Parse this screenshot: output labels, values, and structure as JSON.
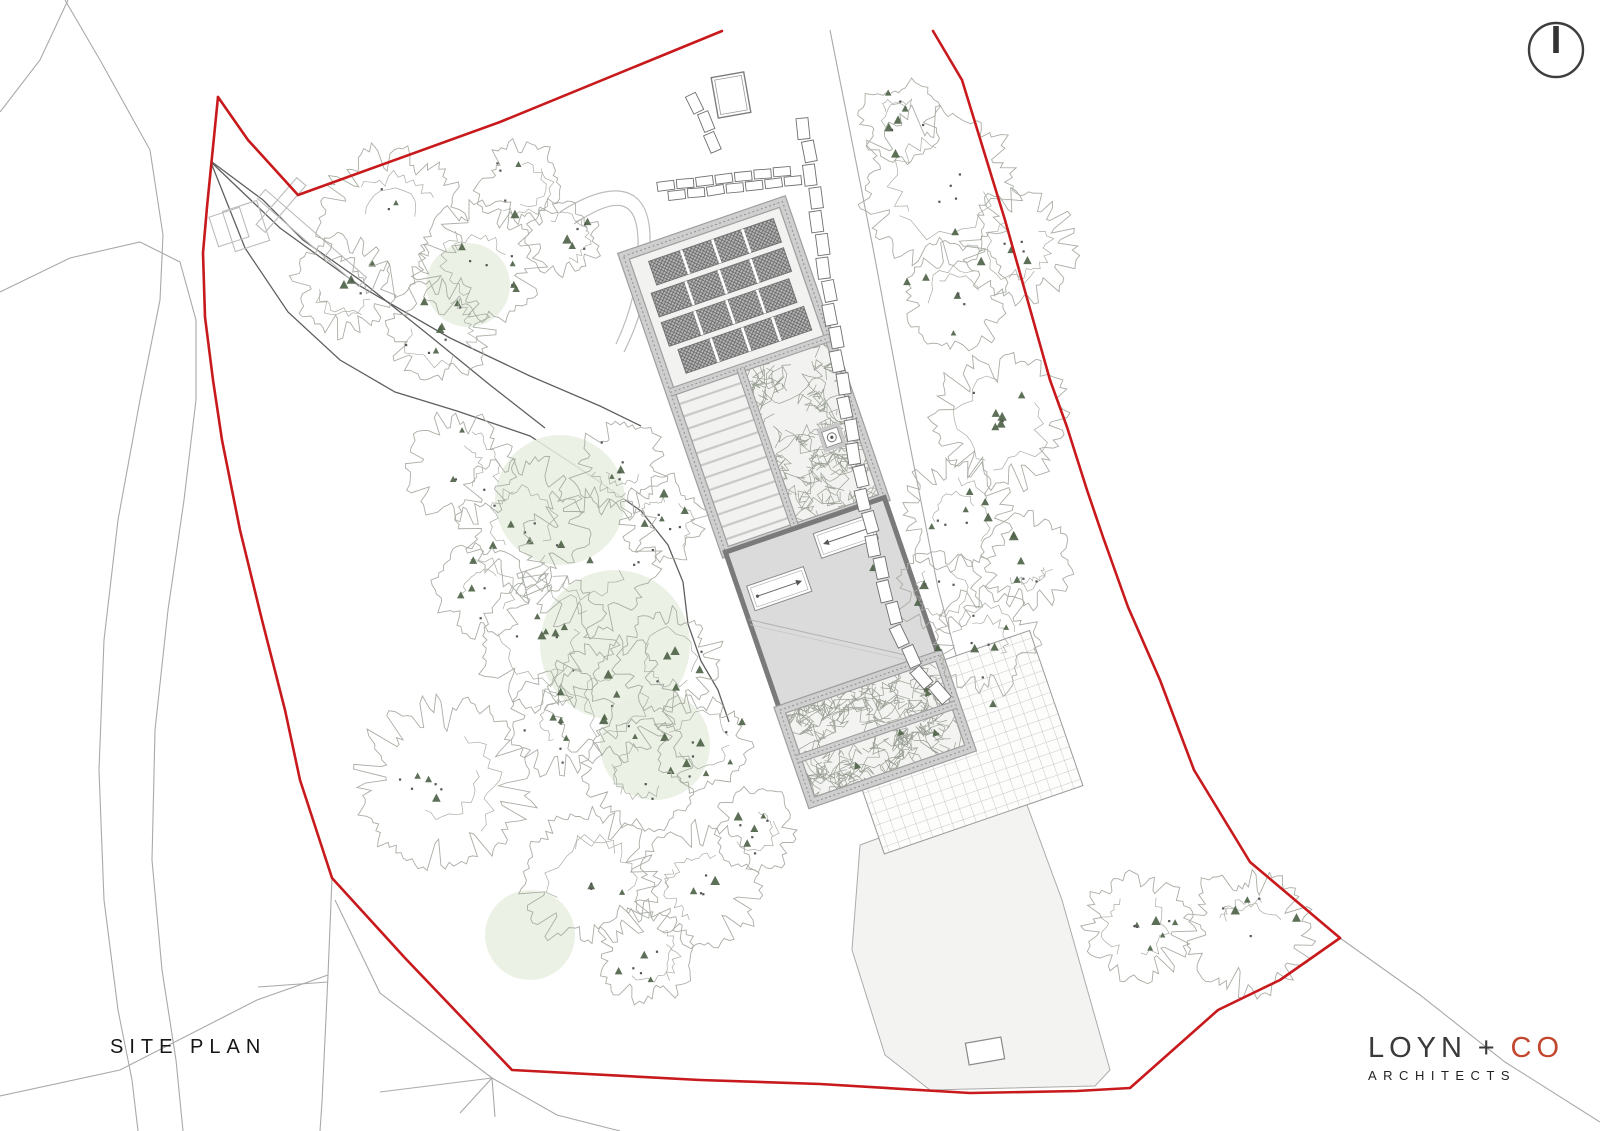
{
  "title": {
    "label": "SITE PLAN"
  },
  "logo": {
    "name_dark": "LOYN + ",
    "name_accent": "CO",
    "sub": "ARCHITECTS"
  },
  "colors": {
    "boundary_red": "#c8191c",
    "logo_accent": "#c2472e",
    "tree_line": "#a9aea4",
    "conifer_green": "#4f6449",
    "tint_green": "#e9efe2",
    "drive_line": "#5f5f5f",
    "context_line": "#a9a9a9",
    "light_line": "#bcbcbc",
    "building_fill": "#dbdbdb",
    "building_edge": "#7a7a7a",
    "band_light": "#cfcfcf",
    "band_dark": "#9e9e9e",
    "field_fill": "#f3f3f2",
    "scribble": "#9aa095"
  },
  "north_arrow": {
    "cx": 1556,
    "cy": 50,
    "r": 27
  },
  "site": {
    "boundary_top": [
      [
        218,
        97
      ],
      [
        248,
        140
      ],
      [
        298,
        195
      ],
      [
        500,
        122
      ],
      [
        722,
        31
      ]
    ],
    "boundary_right": [
      [
        933,
        31
      ],
      [
        962,
        80
      ],
      [
        1005,
        220
      ],
      [
        1050,
        380
      ],
      [
        1067,
        427
      ],
      [
        1087,
        490
      ],
      [
        1103,
        537
      ],
      [
        1128,
        607
      ],
      [
        1160,
        680
      ],
      [
        1194,
        770
      ],
      [
        1250,
        862
      ],
      [
        1340,
        938
      ]
    ],
    "boundary_left_bottom": [
      [
        218,
        97
      ],
      [
        207,
        207
      ],
      [
        203,
        253
      ],
      [
        205,
        317
      ],
      [
        213,
        380
      ],
      [
        222,
        440
      ],
      [
        240,
        530
      ],
      [
        262,
        620
      ],
      [
        285,
        710
      ],
      [
        300,
        780
      ],
      [
        332,
        878
      ],
      [
        405,
        958
      ],
      [
        512,
        1070
      ],
      [
        700,
        1080
      ],
      [
        820,
        1084
      ],
      [
        970,
        1093
      ],
      [
        1077,
        1091
      ],
      [
        1130,
        1088
      ],
      [
        1218,
        1010
      ],
      [
        1280,
        980
      ],
      [
        1340,
        938
      ]
    ],
    "context_lines": [
      [
        [
          65,
          0
        ],
        [
          100,
          60
        ],
        [
          150,
          150
        ],
        [
          163,
          235
        ],
        [
          160,
          300
        ],
        [
          140,
          400
        ],
        [
          118,
          520
        ],
        [
          104,
          640
        ],
        [
          99,
          770
        ],
        [
          104,
          900
        ],
        [
          118,
          1010
        ],
        [
          132,
          1080
        ],
        [
          138,
          1131
        ]
      ],
      [
        [
          0,
          292
        ],
        [
          70,
          258
        ],
        [
          140,
          242
        ],
        [
          180,
          262
        ],
        [
          196,
          320
        ],
        [
          196,
          400
        ],
        [
          184,
          500
        ],
        [
          168,
          610
        ],
        [
          155,
          730
        ],
        [
          152,
          860
        ],
        [
          162,
          970
        ],
        [
          176,
          1060
        ],
        [
          183,
          1131
        ]
      ],
      [
        [
          68,
          0
        ],
        [
          40,
          60
        ],
        [
          0,
          112
        ]
      ],
      [
        [
          300,
          781
        ],
        [
          332,
          878
        ],
        [
          328,
          975
        ],
        [
          322,
          1102
        ],
        [
          320,
          1131
        ]
      ],
      [
        [
          0,
          1096
        ],
        [
          120,
          1070
        ],
        [
          257,
          1000
        ],
        [
          328,
          975
        ]
      ],
      [
        [
          258,
          987
        ],
        [
          328,
          982
        ]
      ],
      [
        [
          875,
          792
        ],
        [
          963,
          1082
        ]
      ],
      [
        [
          335,
          900
        ],
        [
          380,
          993
        ],
        [
          492,
          1078
        ]
      ],
      [
        [
          380,
          1092
        ],
        [
          492,
          1078
        ]
      ],
      [
        [
          492,
          1078
        ],
        [
          460,
          1113
        ]
      ],
      [
        [
          492,
          1078
        ],
        [
          495,
          1117
        ]
      ],
      [
        [
          492,
          1078
        ],
        [
          557,
          1115
        ],
        [
          620,
          1131
        ]
      ],
      [
        [
          1340,
          938
        ],
        [
          1420,
          995
        ],
        [
          1505,
          1062
        ],
        [
          1600,
          1122
        ]
      ],
      [
        [
          830,
          30
        ],
        [
          873,
          248
        ],
        [
          905,
          420
        ],
        [
          938,
          588
        ],
        [
          968,
          700
        ]
      ]
    ],
    "turning_arcs": [
      "M560,212 C610,180 648,182 650,235 C651,285 640,320 624,352",
      "M574,224 C616,196 637,198 638,240 C639,283 630,314 616,344"
    ],
    "drive_lines": [
      [
        [
          211,
          162
        ],
        [
          280,
          228
        ],
        [
          360,
          286
        ],
        [
          450,
          338
        ],
        [
          530,
          376
        ],
        [
          600,
          406
        ],
        [
          641,
          426
        ]
      ],
      [
        [
          212,
          165
        ],
        [
          245,
          248
        ],
        [
          288,
          312
        ],
        [
          340,
          360
        ],
        [
          395,
          392
        ],
        [
          457,
          411
        ],
        [
          530,
          436
        ],
        [
          594,
          478
        ],
        [
          641,
          511
        ],
        [
          668,
          545
        ],
        [
          683,
          582
        ],
        [
          688,
          624
        ],
        [
          701,
          661
        ],
        [
          718,
          690
        ],
        [
          729,
          722
        ]
      ],
      [
        [
          212,
          162
        ],
        [
          263,
          200
        ],
        [
          303,
          240
        ],
        [
          360,
          280
        ],
        [
          430,
          336
        ],
        [
          490,
          385
        ],
        [
          545,
          428
        ]
      ]
    ],
    "entrance_rects": [
      {
        "cx": 229,
        "cy": 227,
        "w": 32,
        "h": 31,
        "rot": -18
      },
      {
        "cx": 246,
        "cy": 226,
        "w": 36,
        "h": 42,
        "rot": -18
      },
      {
        "cx": 312,
        "cy": 238,
        "w": 134,
        "h": 12,
        "rot": 41
      },
      {
        "cx": 281,
        "cy": 205,
        "w": 62,
        "h": 12,
        "rot": -49
      }
    ],
    "field": [
      [
        860,
        845
      ],
      [
        1020,
        786
      ],
      [
        1062,
        900
      ],
      [
        1110,
        1070
      ],
      [
        1095,
        1086
      ],
      [
        930,
        1090
      ],
      [
        885,
        1055
      ],
      [
        852,
        950
      ]
    ],
    "shed": {
      "cx": 985,
      "cy": 1051,
      "w": 36,
      "h": 22,
      "rot": -10
    },
    "tints": [
      [
        560,
        500,
        65
      ],
      [
        615,
        645,
        75
      ],
      [
        655,
        745,
        55
      ],
      [
        530,
        935,
        45
      ],
      [
        468,
        285,
        42
      ]
    ],
    "trees": [
      [
        390,
        218,
        80
      ],
      [
        478,
        262,
        68
      ],
      [
        345,
        286,
        54
      ],
      [
        520,
        186,
        48
      ],
      [
        440,
        330,
        58
      ],
      [
        565,
        238,
        42
      ],
      [
        900,
        120,
        45
      ],
      [
        938,
        186,
        85
      ],
      [
        1020,
        246,
        62
      ],
      [
        957,
        296,
        58
      ],
      [
        460,
        468,
        62
      ],
      [
        522,
        520,
        72
      ],
      [
        590,
        560,
        78
      ],
      [
        545,
        640,
        72
      ],
      [
        482,
        590,
        52
      ],
      [
        622,
        468,
        52
      ],
      [
        662,
        520,
        48
      ],
      [
        1000,
        422,
        74
      ],
      [
        955,
        515,
        62
      ],
      [
        1026,
        560,
        52
      ],
      [
        986,
        640,
        58
      ],
      [
        938,
        592,
        46
      ],
      [
        610,
        700,
        68
      ],
      [
        670,
        660,
        58
      ],
      [
        562,
        722,
        58
      ],
      [
        640,
        772,
        62
      ],
      [
        702,
        742,
        52
      ],
      [
        443,
        783,
        94
      ],
      [
        590,
        880,
        76
      ],
      [
        700,
        886,
        68
      ],
      [
        646,
        954,
        54
      ],
      [
        756,
        830,
        46
      ],
      [
        1136,
        926,
        60
      ],
      [
        1250,
        932,
        70
      ]
    ],
    "standalone_conifers": [
      [
        907,
        282
      ],
      [
        938,
        648
      ],
      [
        993,
        704
      ],
      [
        873,
        568
      ],
      [
        742,
        722
      ]
    ],
    "walls": {
      "gate_hut": {
        "cx": 731,
        "cy": 95,
        "w": 33,
        "h": 41,
        "rot": -10
      },
      "wall_a": [
        [
          692,
          94
        ],
        [
          722,
          160
        ]
      ],
      "wall_b": [
        [
          658,
          192
        ],
        [
          806,
          174
        ]
      ],
      "wall_c": [
        [
          803,
          118
        ],
        [
          812,
          180
        ],
        [
          822,
          250
        ],
        [
          832,
          320
        ],
        [
          843,
          390
        ],
        [
          855,
          455
        ],
        [
          867,
          515
        ],
        [
          880,
          570
        ],
        [
          896,
          625
        ],
        [
          915,
          668
        ],
        [
          940,
          695
        ],
        [
          962,
          706
        ]
      ]
    },
    "complex": {
      "rotation": -19,
      "pivot": [
        830,
        604
      ],
      "terrace": {
        "x": 800,
        "y": 694,
        "w": 210,
        "h": 164
      },
      "garden": {
        "x": 748,
        "y": 208,
        "w": 168,
        "h": 313,
        "divider_y": 352,
        "divider_x": 822
      },
      "solar_rows": [
        [
          770,
          221,
          132,
          25
        ],
        [
          762,
          252,
          140,
          25
        ],
        [
          762,
          283,
          135,
          25
        ],
        [
          769,
          314,
          133,
          25
        ]
      ],
      "ramp": {
        "x1": 752,
        "x2": 818,
        "y1": 366,
        "y2": 510,
        "step": 13
      },
      "veg_cell": {
        "x": 822,
        "y": 352,
        "w": 94,
        "h": 169
      },
      "water": {
        "x": 874,
        "y": 435,
        "s": 24
      },
      "building": {
        "x": 748,
        "y": 521,
        "w": 168,
        "h": 167
      },
      "rooflights": [
        {
          "x": 757,
          "y": 560,
          "w": 60,
          "h": 26,
          "arrow": "right"
        },
        {
          "x": 837,
          "y": 532,
          "w": 60,
          "h": 26,
          "arrow": "left"
        }
      ],
      "level_lines": [
        [
          738,
          586,
          906,
          690
        ],
        [
          742,
          594,
          910,
          698
        ]
      ],
      "courtyard": {
        "x": 748,
        "y": 688,
        "w": 168,
        "h": 98,
        "cross_y": 740
      }
    }
  }
}
